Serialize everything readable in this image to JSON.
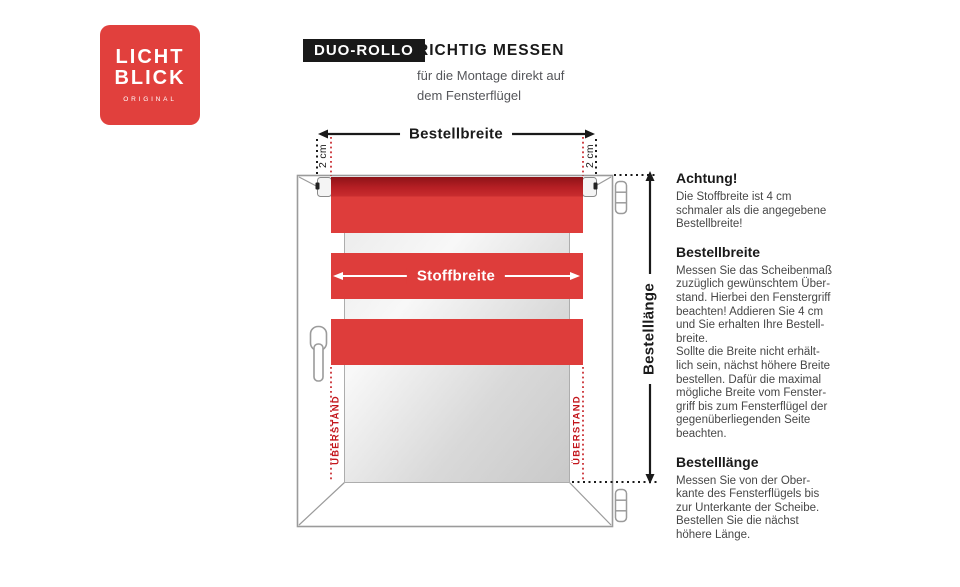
{
  "logo": {
    "word1": "LICHT",
    "word2": "BLICK",
    "tagline": "ORIGINAL",
    "bg_color": "#e1403d"
  },
  "header": {
    "badge": "DUO-ROLLO",
    "title": "RICHTIG MESSEN",
    "subtitle": "für die Montage direkt auf\ndem Fensterflügel"
  },
  "diagram": {
    "order_width_label": "Bestellbreite",
    "fabric_width_label": "Stoffbreite",
    "order_length_label": "Bestelllänge",
    "offset_left_label": "2 cm",
    "offset_right_label": "2 cm",
    "overhang_left_label": "ÜBERSTAND",
    "overhang_right_label": "ÜBERSTAND",
    "colors": {
      "fabric_red": "#de3d3b",
      "tube_red_dark": "#8e1318",
      "tube_red_light": "#c92d2f",
      "marker_red": "#c3161c",
      "frame_gray": "#9b9b9b"
    }
  },
  "info_panel": {
    "sections": [
      {
        "heading": "Achtung!",
        "body": "Die Stoffbreite ist 4 cm\nschmaler als die angegebene\nBestellbreite!"
      },
      {
        "heading": "Bestellbreite",
        "body": "Messen Sie das Scheibenmaß\nzuzüglich gewünschtem Über-\nstand. Hierbei den Fenstergriff\nbeachten! Addieren Sie 4 cm\nund Sie erhalten Ihre Bestell-\nbreite.\nSollte die Breite nicht erhält-\nlich sein, nächst höhere Breite\nbestellen. Dafür die maximal\nmögliche Breite vom Fenster-\ngriff bis zum Fensterflügel der\ngegenüberliegenden Seite\nbeachten."
      },
      {
        "heading": "Bestelllänge",
        "body": "Messen Sie von der Ober-\nkante des Fensterflügels bis\nzur Unterkante der Scheibe.\nBestellen Sie die nächst\nhöhere Länge."
      }
    ]
  }
}
